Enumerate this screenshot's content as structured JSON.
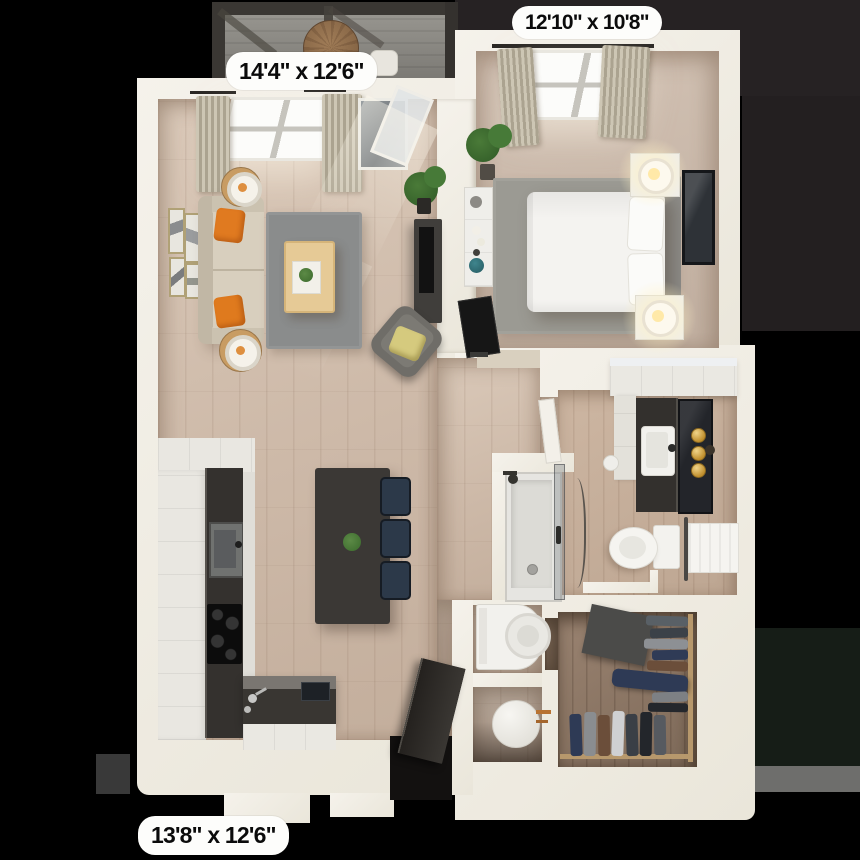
{
  "floor_plan": {
    "background": "#000000",
    "dimension_labels": [
      {
        "id": "living-room",
        "text": "14'4\" x 12'6\""
      },
      {
        "id": "bedroom",
        "text": "12'10\" x 10'8\""
      },
      {
        "id": "kitchen",
        "text": "13'8\" x 12'6\""
      }
    ],
    "colors": {
      "wall": "#efece4",
      "wood_floor": "#cfbcab",
      "carpet": "#c8b7a9",
      "bath_floor": "#c4ad99",
      "closet_floor": "#8f7a69",
      "rug": "#8a8c8c",
      "sofa": "#d8cfbe",
      "accent_pillow_orange": "#e07a20",
      "counter_dark": "#34312e",
      "dining_chair_navy": "#2c3949",
      "vanity_gold": "#c89a3e",
      "balcony_deck": "#8b8985"
    }
  }
}
